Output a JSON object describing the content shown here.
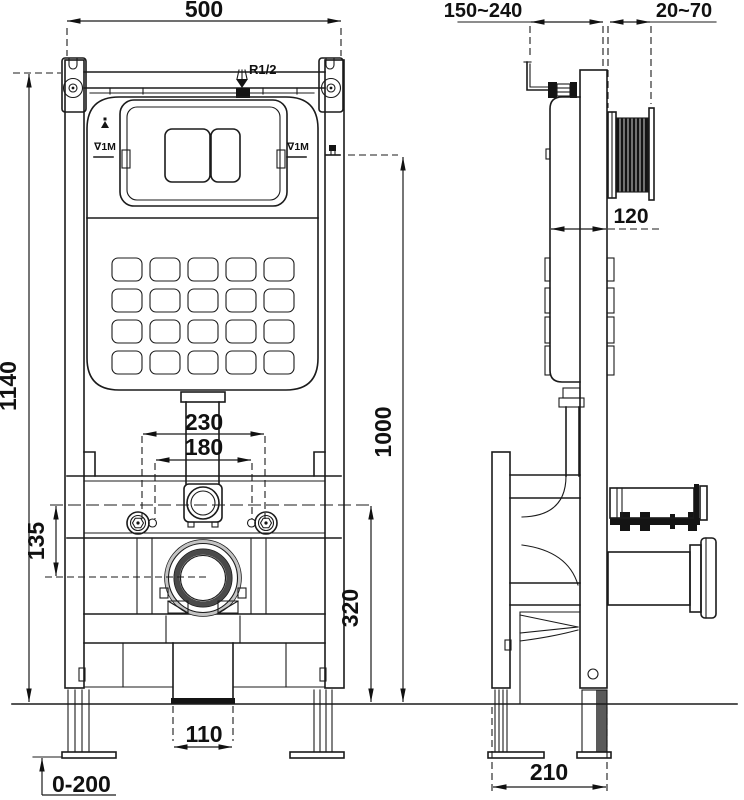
{
  "dims": {
    "front_width": "500",
    "front_height": "1140",
    "flush_plate_height": "1000",
    "fixing_outer": "230",
    "fixing_inner": "180",
    "drain_offset": "135",
    "drain_height": "320",
    "outlet_width": "110",
    "leg_adjust": "0-200",
    "wall_distance": "150~240",
    "plate_range": "20~70",
    "cistern_depth": "120",
    "base_depth": "210"
  },
  "labels": {
    "water_inlet": "R1/2",
    "level_left": "∇1M",
    "level_right": "∇1M"
  }
}
